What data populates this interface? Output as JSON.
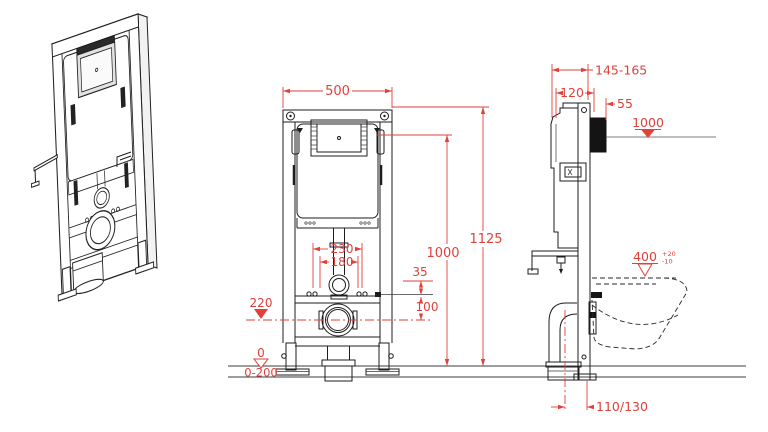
{
  "colors": {
    "line": "#1d1d1d",
    "dimension": "#e2403a",
    "marker": "#e03028"
  },
  "front": {
    "width": "500",
    "total_height": "1125",
    "plate_height": "1000",
    "fixing_span_outer": "230",
    "fixing_span_inner": "180",
    "inlet_offset": "35",
    "fixing_to_drain": "100",
    "drain_height": "220",
    "floor_level": "0",
    "floor_range": "0-200"
  },
  "side": {
    "wall_depth_range": "145-165",
    "frame_depth": "120",
    "plate_offset": "55",
    "plate_height": "1000",
    "bowl_height": "400",
    "bowl_tol_plus": "+20",
    "bowl_tol_minus": "-10",
    "drain_wall_distance": "110/130"
  }
}
